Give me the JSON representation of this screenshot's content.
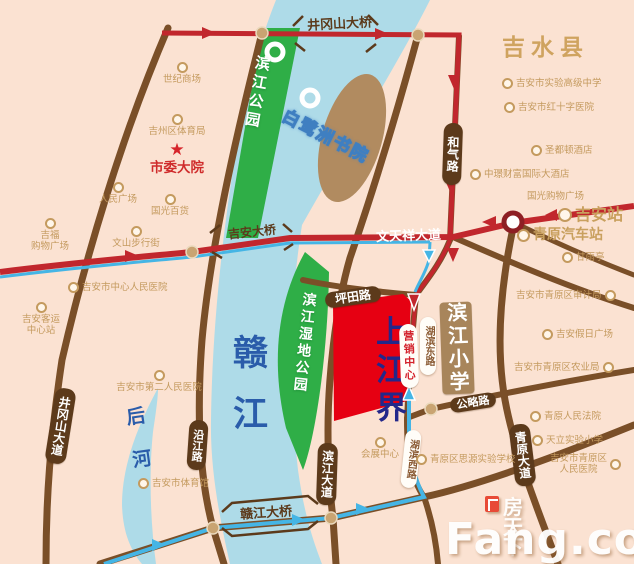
{
  "regions": {
    "county": "吉水县",
    "river": "赣江",
    "back_river": "后河",
    "park_binjiang": "滨江公园",
    "park_wetland": "滨江湿地公园",
    "island_academy": "白鹭洲书院",
    "property": "上江界",
    "marketing_center": "营销中心",
    "school_binjiang": "滨江小学"
  },
  "roads": {
    "jinggangshan_bridge": "井冈山大桥",
    "jinggangshan_avenue": "井冈山大道",
    "yanjiang_road": "沿江路",
    "binjiang_avenue": "滨江大道",
    "jian_bridge": "吉安大桥",
    "wentianxiang_avenue": "文天祥大道",
    "ganjiang_bridge": "赣江大桥",
    "pingtian_road": "坪田路",
    "heqi_road": "和气路",
    "hubin_east_road": "湖滨东路",
    "hubin_west_road": "湖滨西路",
    "gonglue_road": "公略路",
    "qingyuan_avenue": "青原大道"
  },
  "stations": {
    "jian_station": "吉安站",
    "qingyuan_bus_station": "青原汽车站"
  },
  "pois": {
    "shiji_mall": "世纪商场",
    "jizhou_sports": "吉州区体育局",
    "shiwei_compound": "市委大院",
    "renmin_square": "人民广场",
    "guoguang_dept": "国光百货",
    "jifu_mall_l1": "吉福",
    "jifu_mall_l2": "购物广场",
    "wenshan_street": "文山步行街",
    "central_hospital": "吉安市中心人民医院",
    "bus_center_l1": "吉安客运",
    "bus_center_l2": "中心站",
    "second_hospital": "吉安市第二人民医院",
    "sports_center": "吉安市体育馆",
    "shiyan_school": "吉安市实验高级中学",
    "redcross_hospital": "吉安市红十字医院",
    "hotel_shengdu": "圣都顿酒店",
    "hotel_fortune": "中璟财富国际大酒店",
    "guoguang_mall": "国光购物广场",
    "ganyuting": "甘雨亭",
    "audit_bureau": "吉安市青原区审计局",
    "holiday_square": "吉安假日广场",
    "agriculture_bureau": "吉安市青原区农业局",
    "qingyuan_court": "青原人民法院",
    "tianli_school": "天立实验小学",
    "siyuan_school": "青原区思源实验学校",
    "qingyuan_hospital_l1": "吉安市青原区",
    "qingyuan_hospital_l2": "人民医院",
    "exhibition_center": "会展中心"
  },
  "watermark": {
    "brand_cn": "房天下",
    "brand_en": "Fang.com"
  },
  "colors": {
    "land_pink": "#fbe2d2",
    "water_blue": "#aedbe8",
    "park_green": "#2fae47",
    "island_tan": "#b18b60",
    "road_brown": "#7a4f28",
    "route_red": "#c1272d",
    "route_blue": "#45b5e5",
    "property_red": "#e60012",
    "capsule_brown": "#5c3a1b",
    "poi_tan": "#c49a5e",
    "river_text_blue": "#2a5caa",
    "property_text_blue": "#23278a"
  }
}
